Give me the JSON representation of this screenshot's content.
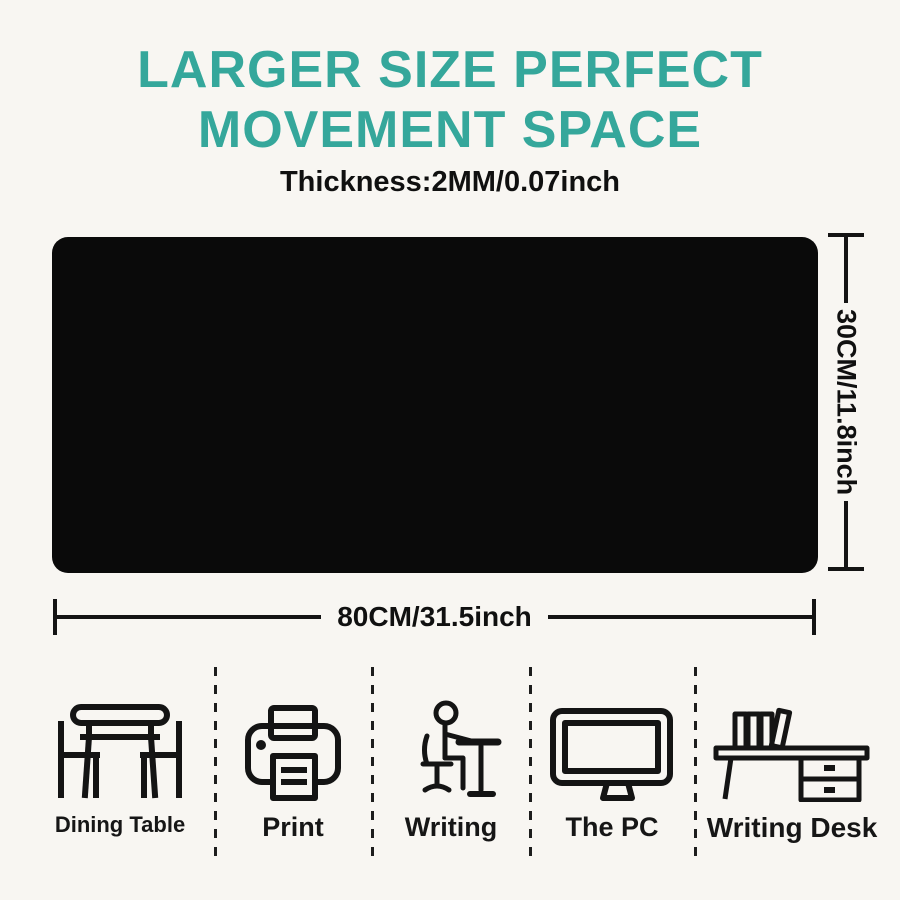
{
  "colors": {
    "bg": "#f8f6f2",
    "accent": "#35a79b",
    "ink": "#141414",
    "pad": "#0a0a0a"
  },
  "header": {
    "title_line1": "LARGER SIZE PERFECT",
    "title_line2": "MOVEMENT SPACE",
    "thickness": "Thickness:2MM/0.07inch"
  },
  "product": {
    "name": "mouse-pad",
    "height_label": "30CM/11.8inch",
    "width_label": "80CM/31.5inch"
  },
  "use_cases": [
    {
      "label": "Dining Table",
      "icon": "dining-table-icon"
    },
    {
      "label": "Print",
      "icon": "printer-icon"
    },
    {
      "label": "Writing",
      "icon": "writing-person-icon"
    },
    {
      "label": "The PC",
      "icon": "monitor-icon"
    },
    {
      "label": "Writing Desk",
      "icon": "writing-desk-icon"
    }
  ]
}
